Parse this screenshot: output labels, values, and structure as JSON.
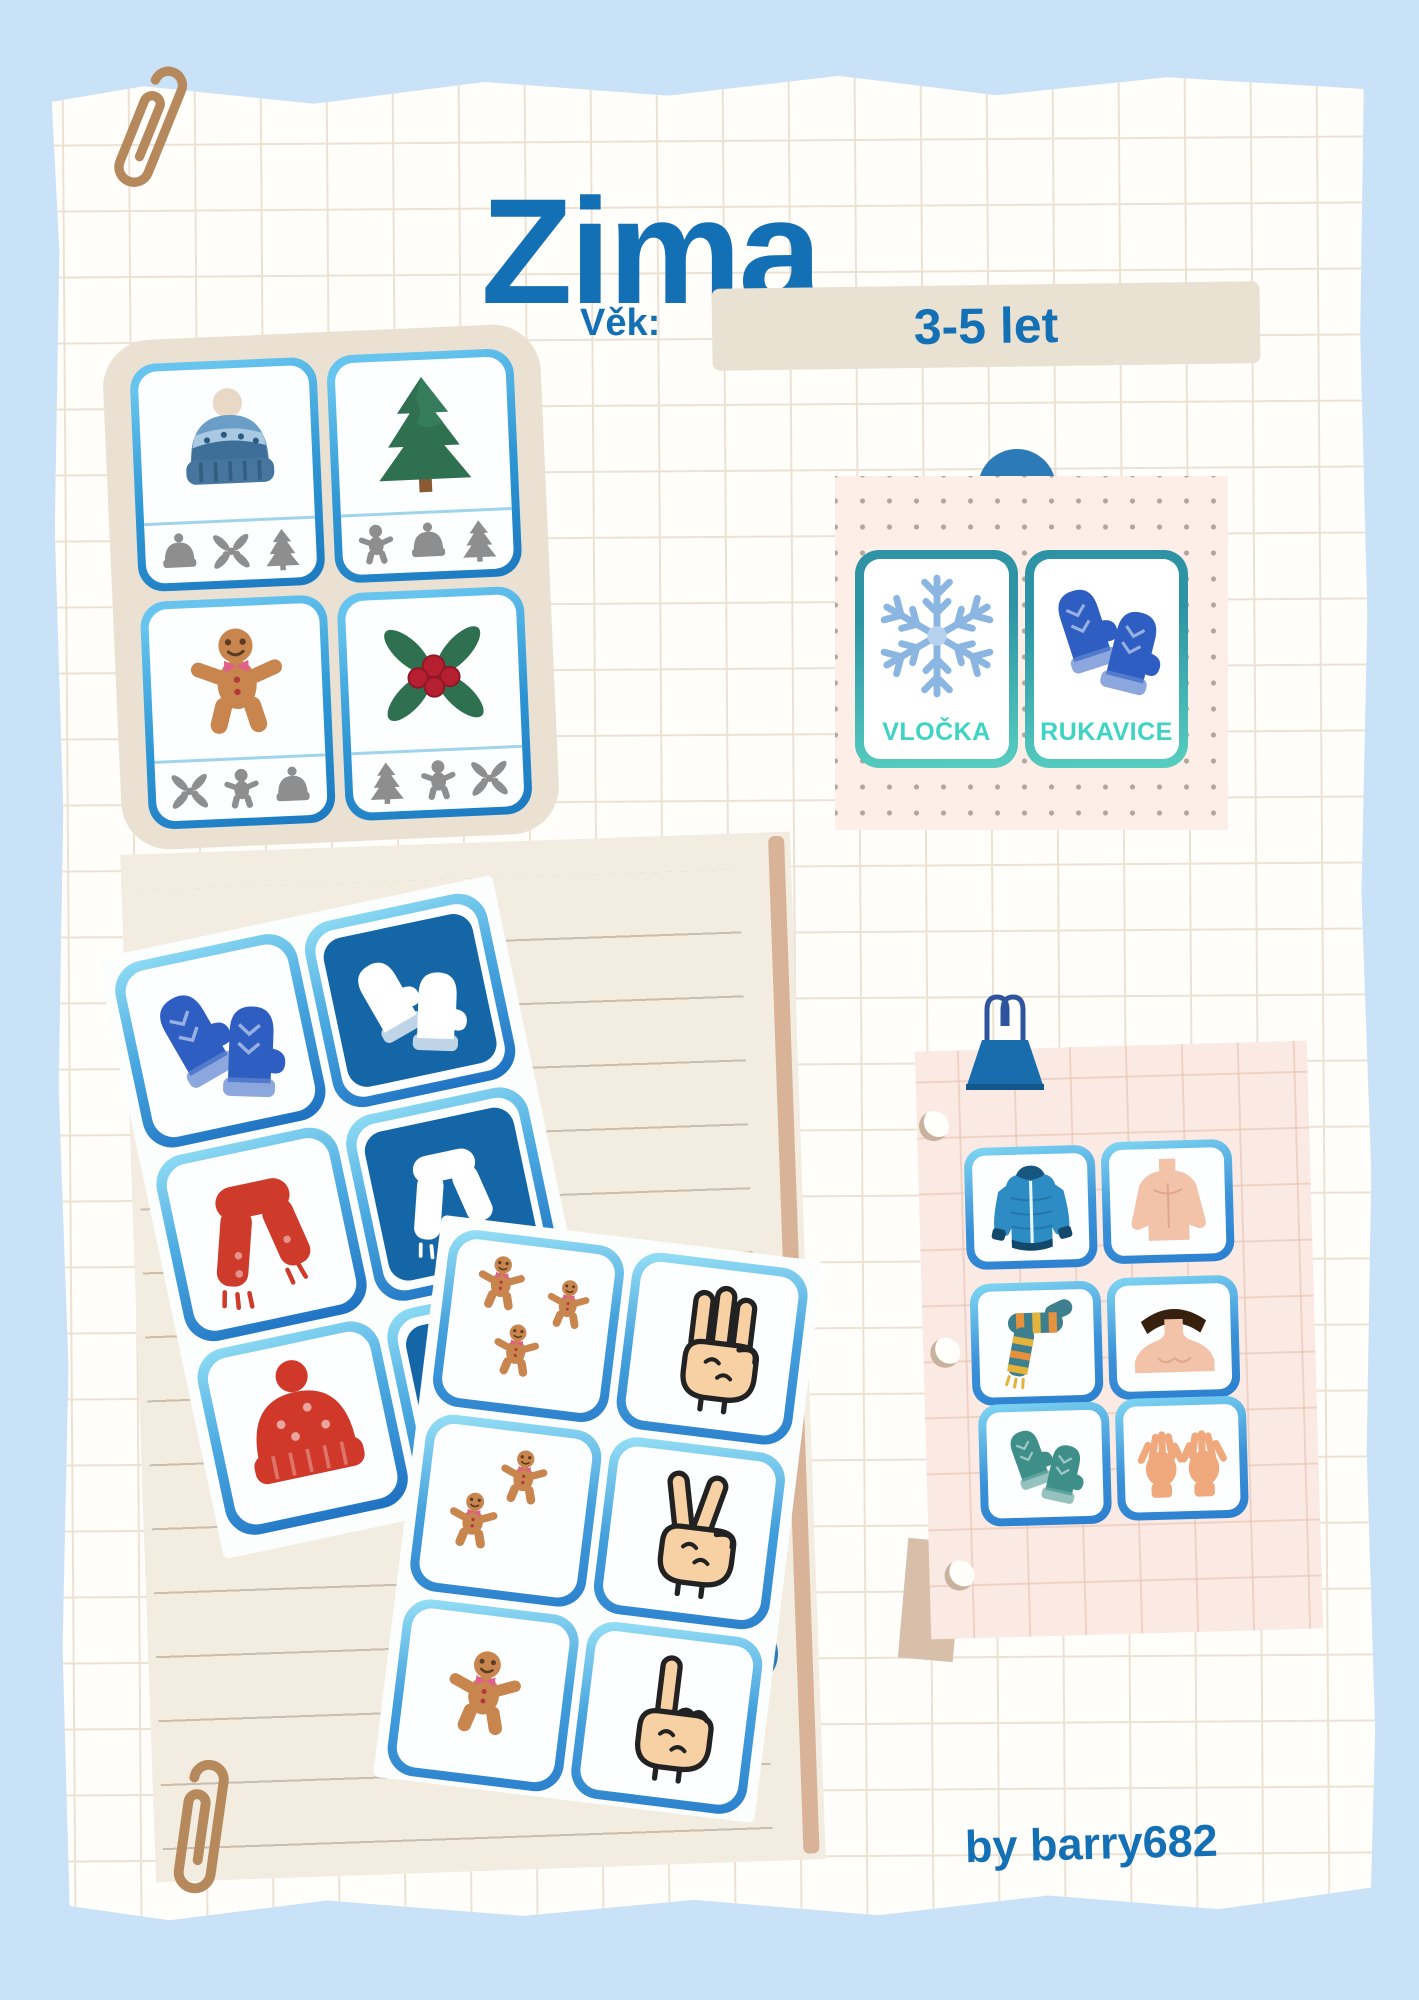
{
  "poster": {
    "title": "Zima",
    "age_label": "Věk:",
    "age_value": "3-5 let",
    "credit": "by barry682"
  },
  "colors": {
    "page_background": "#c9e2f8",
    "paper": "#fffefb",
    "grid_line": "#ece2d3",
    "title_blue": "#1470b5",
    "board_beige": "#eae1d3",
    "card_border_blue": "#1d7fc6",
    "pictogram_blue": "#1566a6",
    "word_card_teal_border": "#2e93a5",
    "word_label_turquoise": "#3ed3c2",
    "word_paper_pink": "#fdeee8",
    "lined_paper_cream": "#f2ece1",
    "body_paper_pink": "#fbeae3",
    "accent_circle_blue": "#2d7ab9",
    "paperclip_brown": "#b5895c",
    "binder_clip_blue": "#1a6dac"
  },
  "matching_board": {
    "cards": [
      {
        "main_icon": "winter-hat",
        "option_icons": [
          "winter-hat",
          "holly",
          "pine-tree"
        ]
      },
      {
        "main_icon": "pine-tree",
        "option_icons": [
          "gingerbread-man",
          "winter-hat",
          "pine-tree"
        ]
      },
      {
        "main_icon": "gingerbread-man",
        "option_icons": [
          "holly",
          "gingerbread-man",
          "winter-hat"
        ]
      },
      {
        "main_icon": "holly",
        "option_icons": [
          "pine-tree",
          "gingerbread-man",
          "holly"
        ]
      }
    ]
  },
  "word_cards": {
    "cards": [
      {
        "label": "VLOČKA",
        "icon": "snowflake"
      },
      {
        "label": "RUKAVICE",
        "icon": "blue-mittens"
      }
    ]
  },
  "clothes_matching_sheet": {
    "pairs": [
      {
        "photo": "blue-mittens",
        "pictogram": "white-mittens"
      },
      {
        "photo": "red-scarf",
        "pictogram": "white-scarf"
      },
      {
        "photo": "red-winter-hat",
        "pictogram": "white-winter-hat"
      }
    ]
  },
  "counting_sheet": {
    "pairs": [
      {
        "count": 3,
        "objects": "gingerbread-men",
        "hand": "three-fingers"
      },
      {
        "count": 2,
        "objects": "gingerbread-men",
        "hand": "two-fingers"
      },
      {
        "count": 1,
        "objects": "gingerbread-man",
        "hand": "one-finger"
      }
    ]
  },
  "body_matching_paper": {
    "pairs": [
      {
        "clothing": "winter-jacket",
        "body_part": "torso"
      },
      {
        "clothing": "striped-scarf",
        "body_part": "neck"
      },
      {
        "clothing": "teal-mittens",
        "body_part": "hands"
      }
    ]
  }
}
